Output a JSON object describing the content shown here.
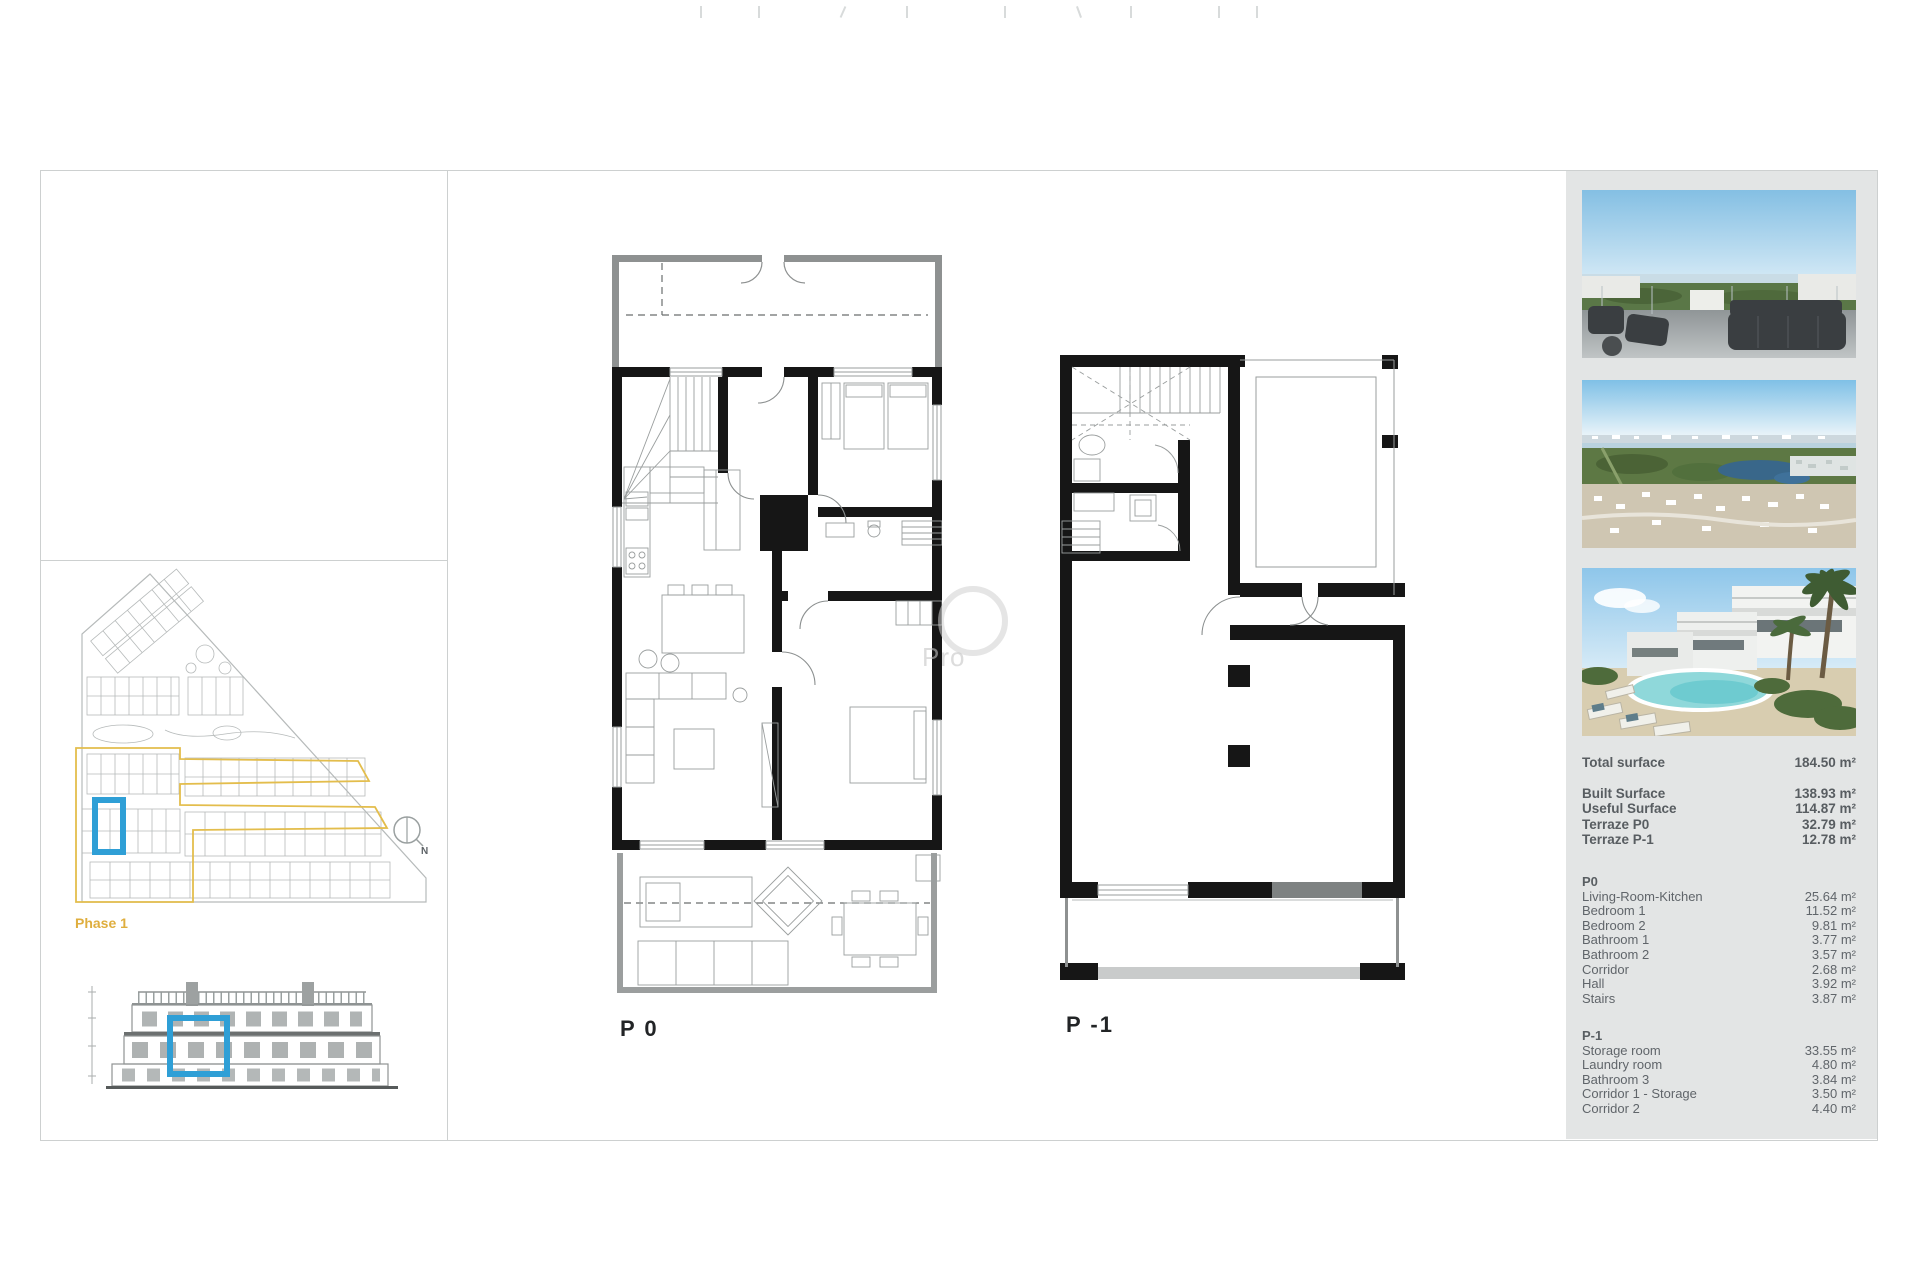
{
  "sheet": {
    "plan_labels": {
      "p0": "P 0",
      "p1": "P -1"
    },
    "site_plan": {
      "phase_label": "Phase 1",
      "compass_label": "N"
    },
    "watermark_text": "Pro"
  },
  "sidebar": {
    "photos": [
      "rooftop-terrace-render",
      "aerial-resort-view",
      "villas-pool-render"
    ],
    "summary": {
      "total": {
        "label": "Total surface",
        "value": "184.50 m²"
      },
      "rows": [
        {
          "label": "Built Surface",
          "value": "138.93 m²"
        },
        {
          "label": "Useful Surface",
          "value": "114.87 m²"
        },
        {
          "label": "Terraze P0",
          "value": "32.79 m²"
        },
        {
          "label": "Terraze P-1",
          "value": "12.78 m²"
        }
      ]
    },
    "sections": [
      {
        "title": "P0",
        "rows": [
          {
            "label": "Living-Room-Kitchen",
            "value": "25.64 m²"
          },
          {
            "label": "Bedroom 1",
            "value": "11.52 m²"
          },
          {
            "label": "Bedroom 2",
            "value": "9.81 m²"
          },
          {
            "label": "Bathroom 1",
            "value": "3.77 m²"
          },
          {
            "label": "Bathroom 2",
            "value": "3.57 m²"
          },
          {
            "label": "Corridor",
            "value": "2.68 m²"
          },
          {
            "label": "Hall",
            "value": "3.92 m²"
          },
          {
            "label": "Stairs",
            "value": "3.87 m²"
          }
        ]
      },
      {
        "title": "P-1",
        "rows": [
          {
            "label": "Storage room",
            "value": "33.55 m²"
          },
          {
            "label": "Laundry room",
            "value": "4.80 m²"
          },
          {
            "label": "Bathroom 3",
            "value": "3.84 m²"
          },
          {
            "label": "Corridor 1 - Storage",
            "value": "3.50 m²"
          },
          {
            "label": "Corridor 2",
            "value": "4.40 m²"
          }
        ]
      }
    ]
  },
  "colors": {
    "accent_blue": "#2f9fd6",
    "phase_gold": "#e3bd4c",
    "panel_bg": "#e3e5e5",
    "wall_black": "#161616"
  }
}
